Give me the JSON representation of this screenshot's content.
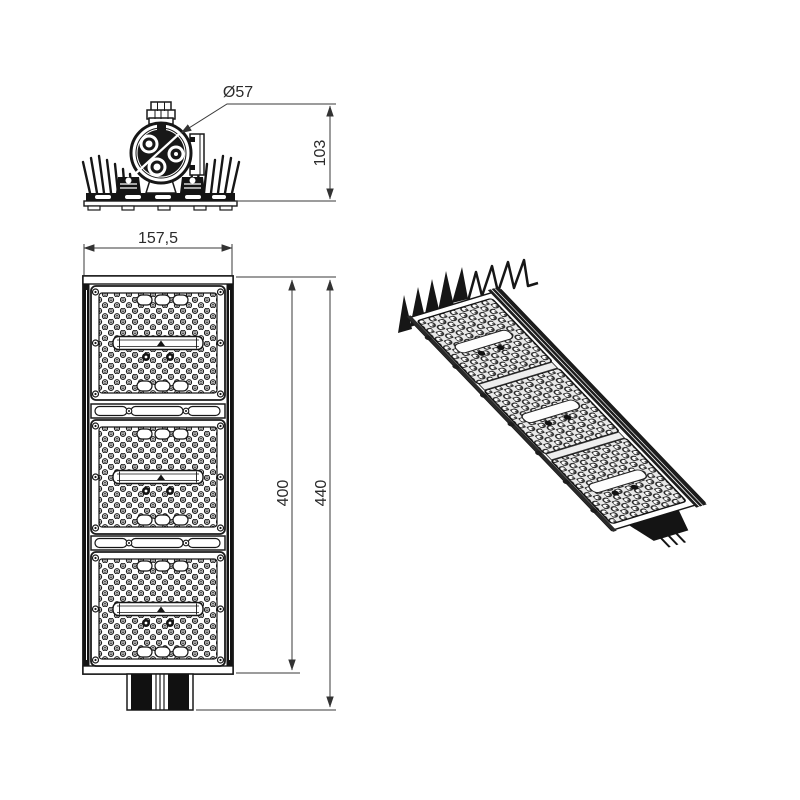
{
  "drawing": {
    "background": "#ffffff",
    "ink_color": "#1a1a1a",
    "dimension_color": "#2e2e2e",
    "dimensions": {
      "clamp_diameter": "Ø57",
      "body_height": "103",
      "body_width": "157,5",
      "panel_length": "400",
      "overall_length": "440"
    }
  }
}
